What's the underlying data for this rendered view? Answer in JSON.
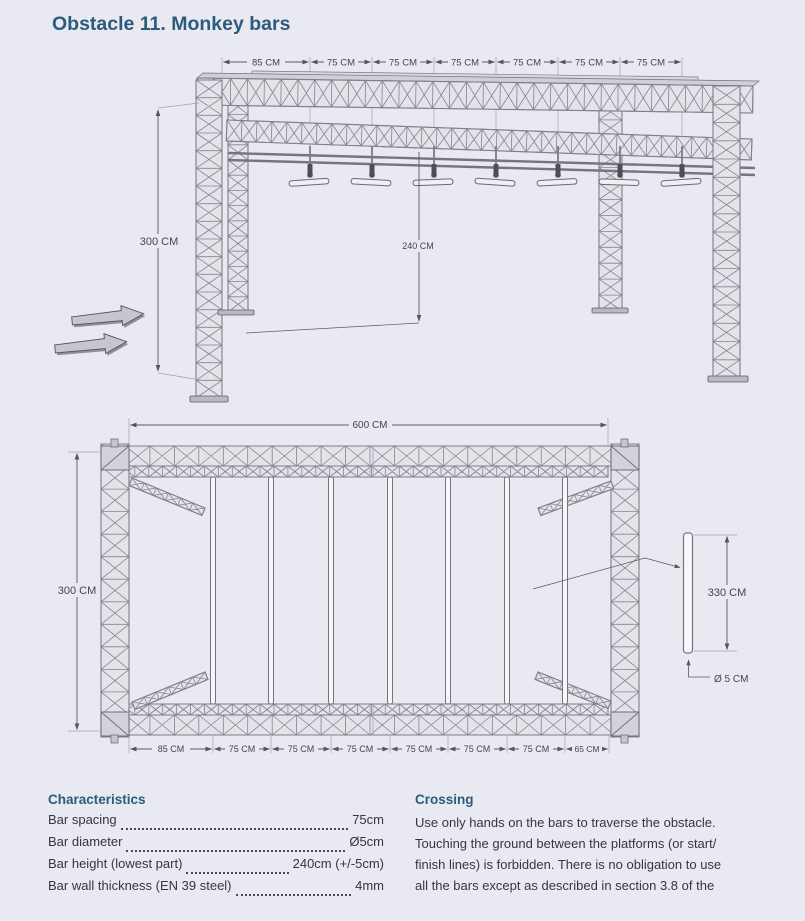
{
  "page": {
    "title": "Obstacle 11. Monkey bars"
  },
  "colors": {
    "accent": "#2c5b7e",
    "background": "#e9e9f1",
    "drawing_line": "#6f6f78",
    "dimension_text": "#45454e"
  },
  "drawing3d": {
    "top_dims": [
      "85 CM",
      "75 CM",
      "75 CM",
      "75 CM",
      "75 CM",
      "75 CM",
      "75 CM"
    ],
    "height_label": "300 CM",
    "bar_clearance_label": "240 CM"
  },
  "plan": {
    "width_label": "600 CM",
    "depth_label": "300 CM",
    "bar_length_label": "330 CM",
    "bar_diameter_label": "Ø 5 CM",
    "bottom_dims": [
      "85 CM",
      "75 CM",
      "75 CM",
      "75 CM",
      "75 CM",
      "75 CM",
      "75 CM",
      "65 CM"
    ]
  },
  "characteristics": {
    "heading": "Characteristics",
    "rows": [
      {
        "label": "Bar spacing",
        "value": "75cm"
      },
      {
        "label": "Bar diameter",
        "value": "Ø5cm"
      },
      {
        "label": "Bar height (lowest part)",
        "value": "240cm (+/-5cm)"
      },
      {
        "label": "Bar wall thickness (EN 39 steel)",
        "value": "4mm"
      }
    ]
  },
  "crossing": {
    "heading": "Crossing",
    "lines": [
      "Use only hands on the bars to traverse the obstacle.",
      "Touching the ground between the platforms (or start/",
      "finish lines) is forbidden. There is no obligation to use",
      "all the bars except as described in section 3.8 of the"
    ]
  }
}
